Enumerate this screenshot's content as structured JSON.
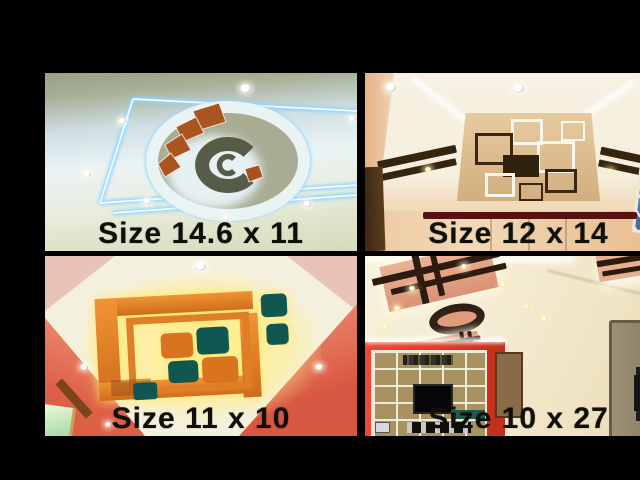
{
  "collage": {
    "items": [
      {
        "name": "top-left",
        "caption": "Size 14.6 x 11"
      },
      {
        "name": "top-right",
        "caption": "Size 12 x 14"
      },
      {
        "name": "bottom-left",
        "caption": "Size 11 x 10"
      },
      {
        "name": "bottom-right",
        "caption": "Size 10 x 27"
      }
    ],
    "colors": {
      "frame_background": "#000000",
      "caption_text": "#101008",
      "tl_led_blue": "#8fd4ff",
      "tl_accent_orange": "#aa5420",
      "tl_circle_dark": "#575c49",
      "tr_panel_tan": "#d9b689",
      "tr_stripe_brown": "#35250f",
      "tr_maroon_bar": "#561110",
      "bl_accent_orange": "#e0812c",
      "bl_accent_teal": "#115650",
      "bl_glow_yellow": "#ffee8c",
      "bl_wall_red": "#dd5f45",
      "br_panel_salmon": "#e2a080",
      "br_bar_brown": "#2d1b10",
      "br_wall_red": "#df3a26"
    }
  }
}
